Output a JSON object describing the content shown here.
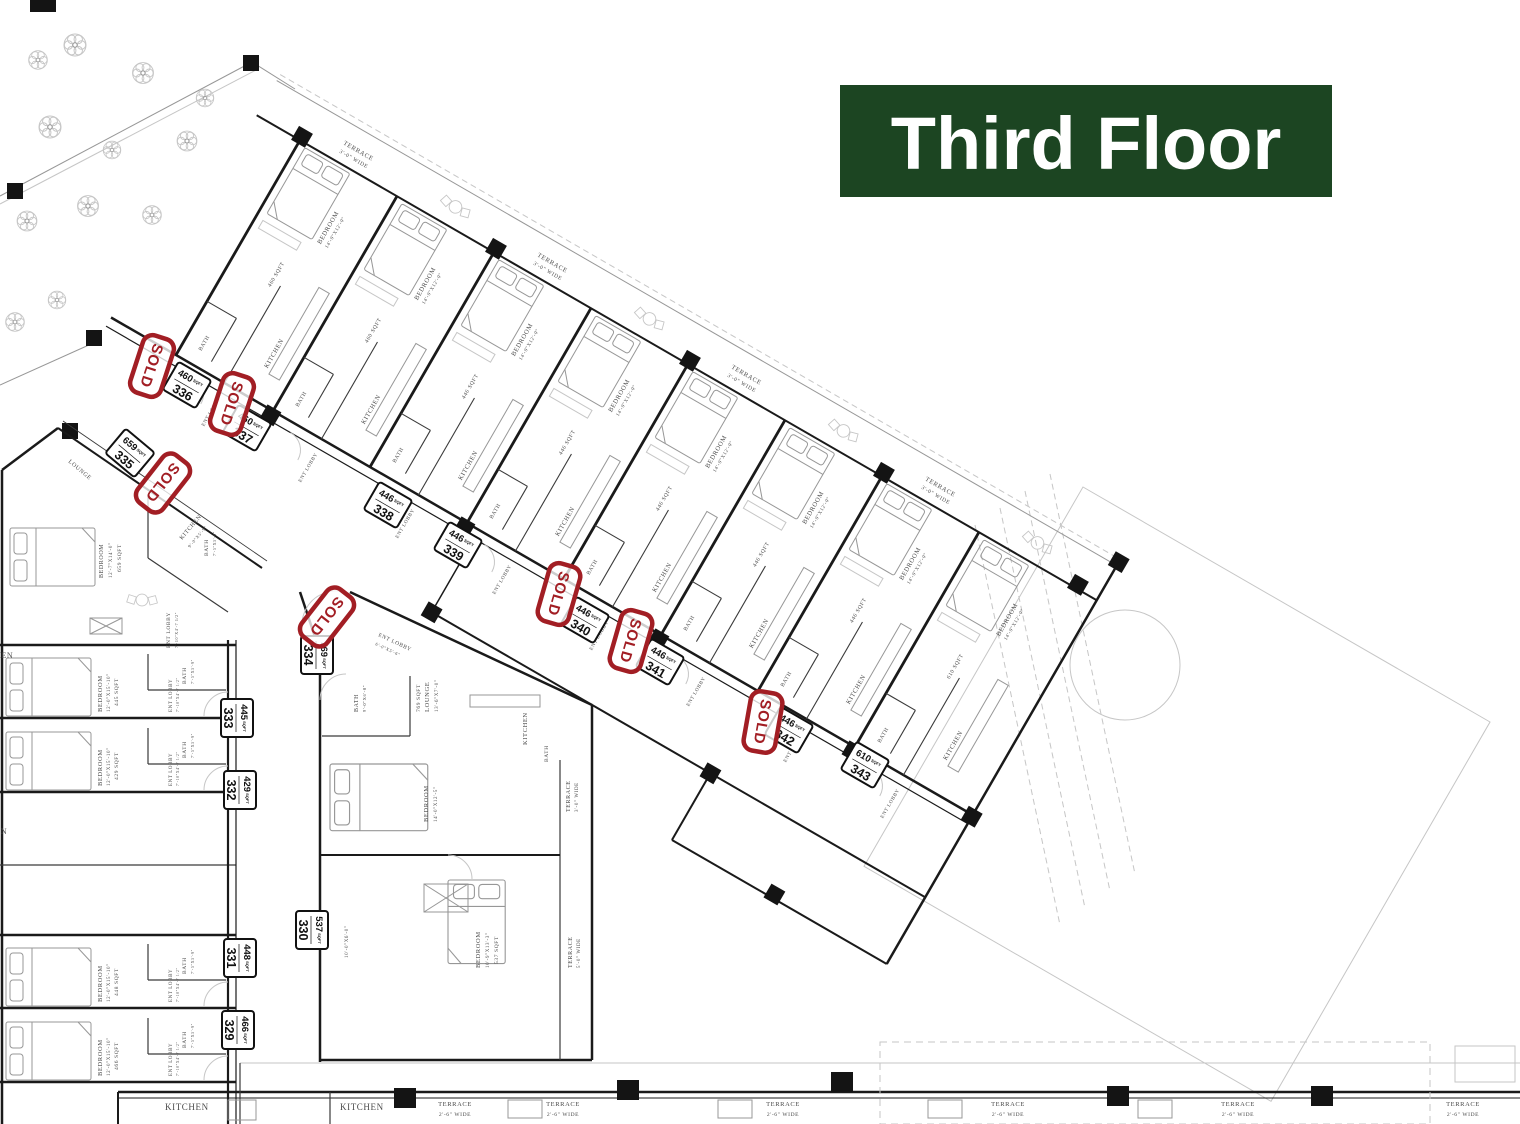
{
  "banner": {
    "title": "Third Floor",
    "bg_color": "#1c4522",
    "text_color": "#ffffff"
  },
  "stamp": {
    "label": "SOLD",
    "color": "#a21e24"
  },
  "labels": {
    "sqft": "SQFT",
    "bedroom": "BEDROOM",
    "kitchen": "KITCHEN",
    "bath": "BATH",
    "ent_lobby": "ENT LOBBY",
    "lounge": "LOUNGE",
    "terrace": "TERRACE"
  },
  "dims": {
    "wing_bedroom": "14'-0\"X12'-0\"",
    "bedroom_335": "12'-7\"X14'-0\"",
    "left_bedroom": "12'-0\"X15'-10\"",
    "left_bath": "7'-5\"X5'-9\"",
    "left_ent_lobby": "7'-10\"X4'-7 1/2\"",
    "kitchen_335": "9'-0\"X5'-9\"",
    "bedroom_334": "14'-0\"X12'-5\"",
    "bath_334": "9'-0\"X6'-0\"",
    "lounge_334": "13'-6\"X7'-0\"",
    "ent_lobby_334": "6'-0\"X5'-6\"",
    "bedroom_330": "10'-9\"X13'-3\"",
    "entry_330": "10'-0\"X6'-0\""
  },
  "terrace": {
    "wing_width": "3'-0\" WIDE",
    "bottom_width": "2'-6\" WIDE",
    "side_width": "5'-0\" WIDE"
  },
  "units": [
    {
      "number": "336",
      "sqft": "460",
      "sold": true
    },
    {
      "number": "337",
      "sqft": "460",
      "sold": true
    },
    {
      "number": "335",
      "sqft": "659",
      "sold": true
    },
    {
      "number": "338",
      "sqft": "446",
      "sold": false
    },
    {
      "number": "339",
      "sqft": "446",
      "sold": false
    },
    {
      "number": "340",
      "sqft": "446",
      "sold": true
    },
    {
      "number": "341",
      "sqft": "446",
      "sold": true
    },
    {
      "number": "342",
      "sqft": "446",
      "sold": true
    },
    {
      "number": "343",
      "sqft": "610",
      "sold": false
    },
    {
      "number": "334",
      "sqft": "769",
      "sold": true
    },
    {
      "number": "333",
      "sqft": "445",
      "sold": false
    },
    {
      "number": "332",
      "sqft": "429",
      "sold": false
    },
    {
      "number": "331",
      "sqft": "448",
      "sold": false
    },
    {
      "number": "330",
      "sqft": "537",
      "sold": false
    },
    {
      "number": "329",
      "sqft": "466",
      "sold": false
    }
  ]
}
